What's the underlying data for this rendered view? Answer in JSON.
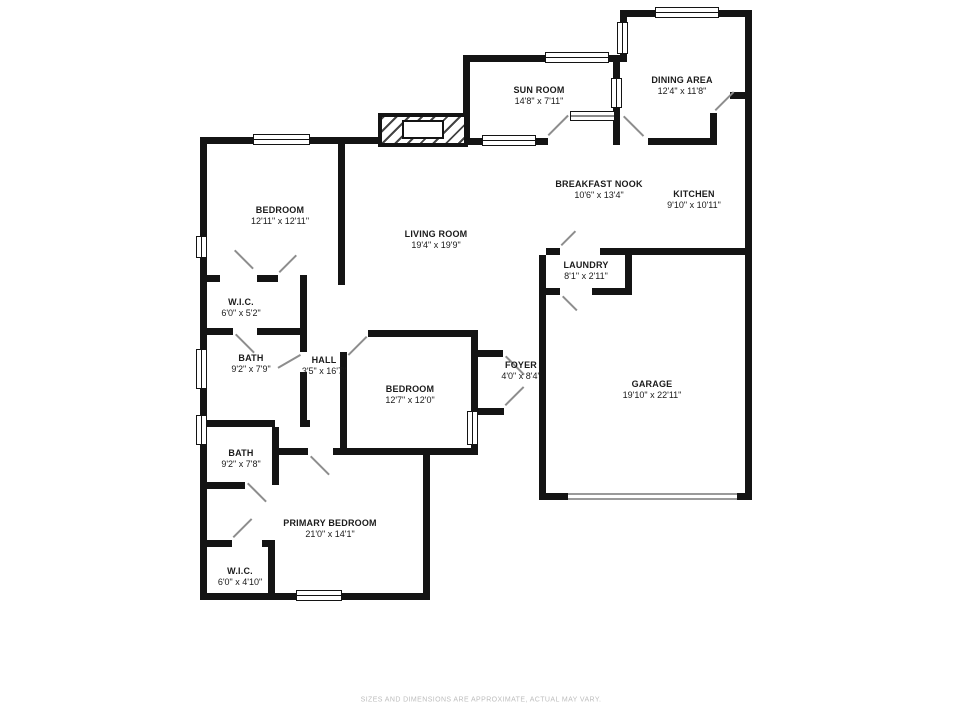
{
  "plan": {
    "disclaimer": "SIZES AND DIMENSIONS ARE APPROXIMATE, ACTUAL MAY VARY.",
    "colors": {
      "walls": "#141414",
      "door_swing": "#8d8d8d",
      "disclaimer_text": "#bdbdbd",
      "background": "#ffffff"
    },
    "rooms": {
      "bedroom1": {
        "name": "BEDROOM",
        "dims": "12'11\" x 12'11\""
      },
      "living": {
        "name": "LIVING ROOM",
        "dims": "19'4\" x 19'9\""
      },
      "sunroom": {
        "name": "SUN ROOM",
        "dims": "14'8\" x 7'11\""
      },
      "dining": {
        "name": "DINING AREA",
        "dims": "12'4\" x 11'8\""
      },
      "breakfast": {
        "name": "BREAKFAST NOOK",
        "dims": "10'6\" x 13'4\""
      },
      "kitchen": {
        "name": "KITCHEN",
        "dims": "9'10\" x 10'11\""
      },
      "laundry": {
        "name": "LAUNDRY",
        "dims": "8'1\" x 2'11\""
      },
      "wic1": {
        "name": "W.I.C.",
        "dims": "6'0\" x 5'2\""
      },
      "bath1": {
        "name": "BATH",
        "dims": "9'2\" x 7'9\""
      },
      "hall": {
        "name": "HALL",
        "dims": "3'5\" x 16'7\""
      },
      "bedroom2": {
        "name": "BEDROOM",
        "dims": "12'7\" x 12'0\""
      },
      "foyer": {
        "name": "FOYER",
        "dims": "4'0\" x 8'4\""
      },
      "garage": {
        "name": "GARAGE",
        "dims": "19'10\" x 22'11\""
      },
      "bath2": {
        "name": "BATH",
        "dims": "9'2\" x 7'8\""
      },
      "primary": {
        "name": "PRIMARY BEDROOM",
        "dims": "21'0\" x 14'1\""
      },
      "wic2": {
        "name": "W.I.C.",
        "dims": "6'0\" x 4'10\""
      }
    }
  }
}
